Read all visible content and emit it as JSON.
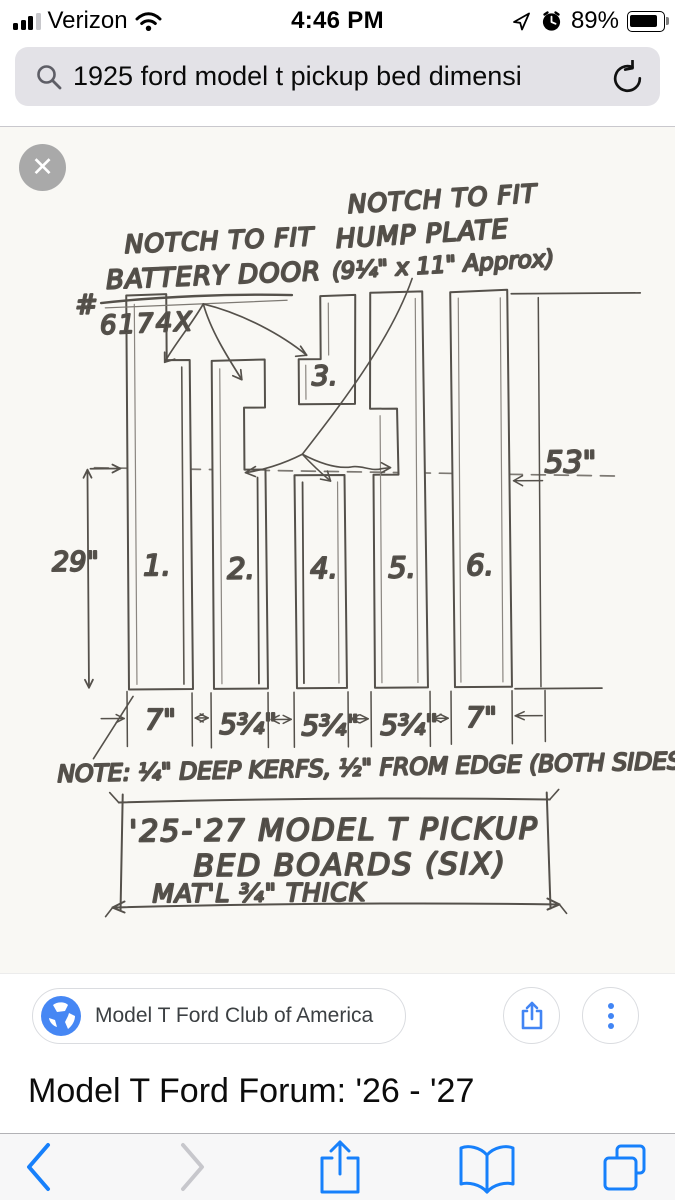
{
  "status": {
    "carrier": "Verizon",
    "time": "4:46 PM",
    "battery": "89%"
  },
  "search": {
    "query": "1925 ford model t pickup bed dimensi"
  },
  "viewer": {
    "close_glyph": "✕"
  },
  "diagram": {
    "labels": {
      "battery_line1": "NOTCH TO FIT",
      "battery_line2": "BATTERY DOOR",
      "part_hash": "#",
      "part_number": "6174X",
      "hump_line1": "NOTCH TO FIT",
      "hump_line2": "HUMP PLATE",
      "hump_line3": "(9¼\" x 11\" Approx)",
      "note": "NOTE: ¼\" DEEP KERFS, ½\" FROM EDGE (BOTH SIDES)",
      "title_line1": "'25-'27 MODEL T PICKUP",
      "title_line2": "BED BOARDS (SIX)",
      "title_line3": "MAT'L ¾\" THICK"
    },
    "board_labels": [
      "1.",
      "2.",
      "3.",
      "4.",
      "5.",
      "6."
    ],
    "dims": {
      "left": "29\"",
      "right": "53\"",
      "widths": [
        "7\"",
        "5¾\"",
        "5¾\"",
        "5¾\"",
        "7\""
      ]
    }
  },
  "attribution": {
    "source": "Model T Ford Club of America"
  },
  "page": {
    "result_title": "Model T Ford Forum: '26 - '27"
  },
  "colors": {
    "ios_blue": "#1780fb",
    "google_blue": "#4285f4",
    "pencil": "#55514b",
    "paper": "#f9f8f4"
  }
}
